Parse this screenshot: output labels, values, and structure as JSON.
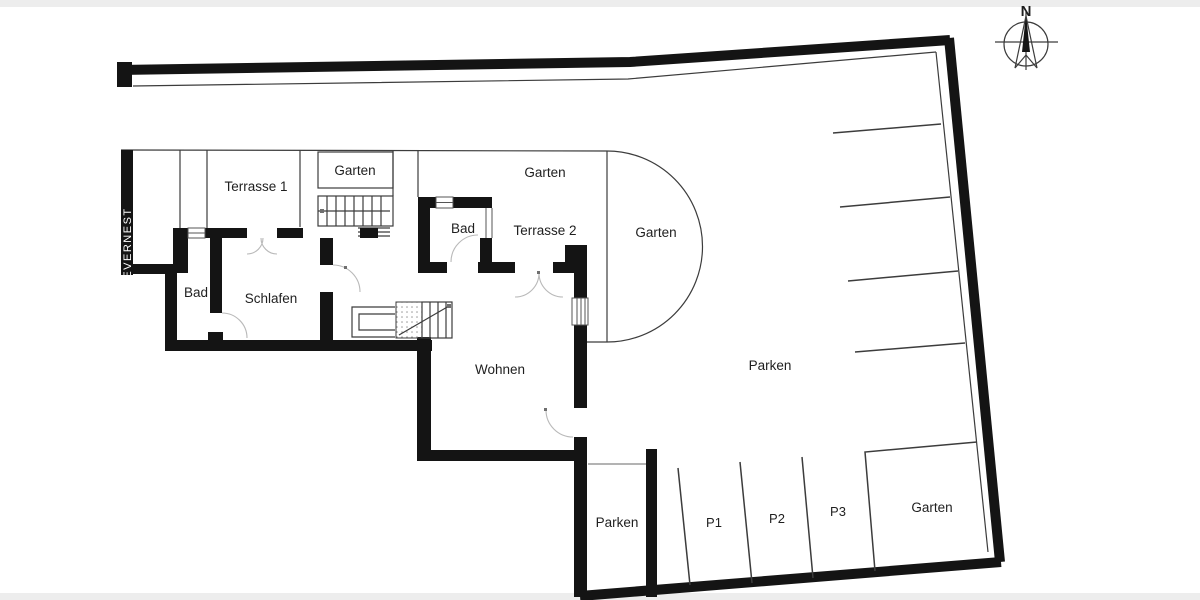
{
  "page": {
    "background": "#ffffff",
    "letterbox_color": "#ededed"
  },
  "colors": {
    "wall": "#141414",
    "thin_line": "#3c3c3c",
    "door_arc": "#b9b9b9",
    "label_text": "#1f1f1f",
    "watermark_text": "#ffffff"
  },
  "branding": {
    "watermark": "EVERNEST"
  },
  "compass": {
    "north_label": "N"
  },
  "rooms": {
    "terrasse1": "Terrasse 1",
    "garten_upper_left": "Garten",
    "garten_top": "Garten",
    "terrasse2": "Terrasse 2",
    "garten_east": "Garten",
    "bad_west": "Bad",
    "schlafen": "Schlafen",
    "bad_east": "Bad",
    "wohnen": "Wohnen",
    "garten_southeast": "Garten"
  },
  "parking": {
    "main": "Parken",
    "small": "Parken",
    "stalls": [
      "P1",
      "P2",
      "P3"
    ]
  }
}
